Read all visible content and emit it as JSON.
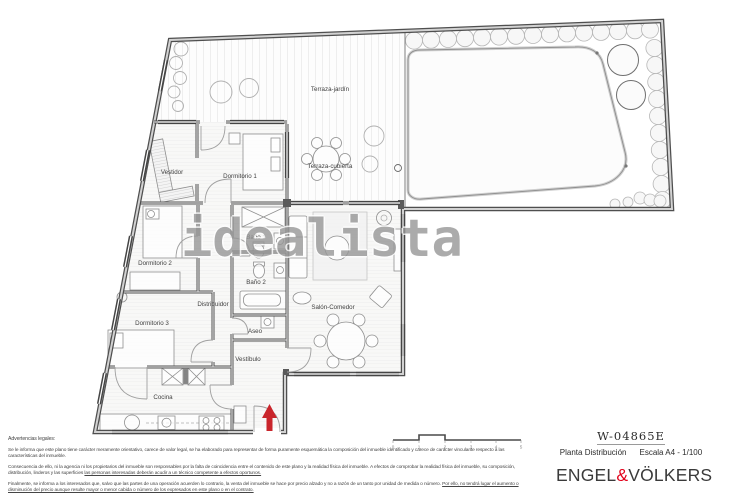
{
  "document": {
    "reference": "W-04865E",
    "plan_title": "Planta Distribución",
    "scale_label": "Escala A4 - 1/100"
  },
  "brand": {
    "left": "ENGEL",
    "ampersand": "&",
    "right": "VÖLKERS",
    "accent_color": "#e2001a"
  },
  "watermark": {
    "text": "idealista"
  },
  "plan": {
    "rooms": {
      "terraza_jardin": "Terraza-jardín",
      "terraza_cubierta": "Terraza-cubierta",
      "dormitorio_1": "Dormitorio 1",
      "vestidor": "Vestidor",
      "dormitorio_2": "Dormitorio 2",
      "dormitorio_3": "Dormitorio 3",
      "distribuidor": "Distribuidor",
      "bano_1": "Baño 1",
      "bano_2": "Baño 2",
      "aseo": "Aseo",
      "vestibulo": "Vestíbulo",
      "cocina": "Cocina",
      "salon_comedor": "Salón-Comedor"
    },
    "entrance_arrow_color": "#c9252b",
    "scale_bar_ticks": [
      "0",
      "1",
      "2",
      "3",
      "4",
      "5"
    ]
  },
  "legal": {
    "heading": "Advertencias legales:",
    "p1": "Se le informa que este plano tiene carácter meramente orientativo, carece de valor legal, se ha elaborado para representar de forma puramente esquemática la composición del inmueble identificado y carece de carácter vinculante respecto a las características del inmueble.",
    "p2_plain": "Consecuencia de ello, ni la agencia ni los propietarios del inmueble son responsables por la falta de coincidencia entre el contenido de este plano y la realidad física del inmueble. A efectos de comprobar la realidad física del inmueble, su composición, distribución, linderos y las superficies ",
    "p2_underlined": "las personas interesadas deberán acudir a un técnico competente a efectos oportunos.",
    "p3_plain": "Finalmente, se informa a los interesados que, salvo que las partes de una operación acuerden lo contrario, la venta del inmueble se hace por precio alzado y no a razón de un tanto por unidad de medida o número. ",
    "p3_underlined": "Por ello, no tendrá lugar el aumento o disminución del precio aunque resulte mayor o menor cabida o número de los expresados en este plano o en el contrato."
  }
}
